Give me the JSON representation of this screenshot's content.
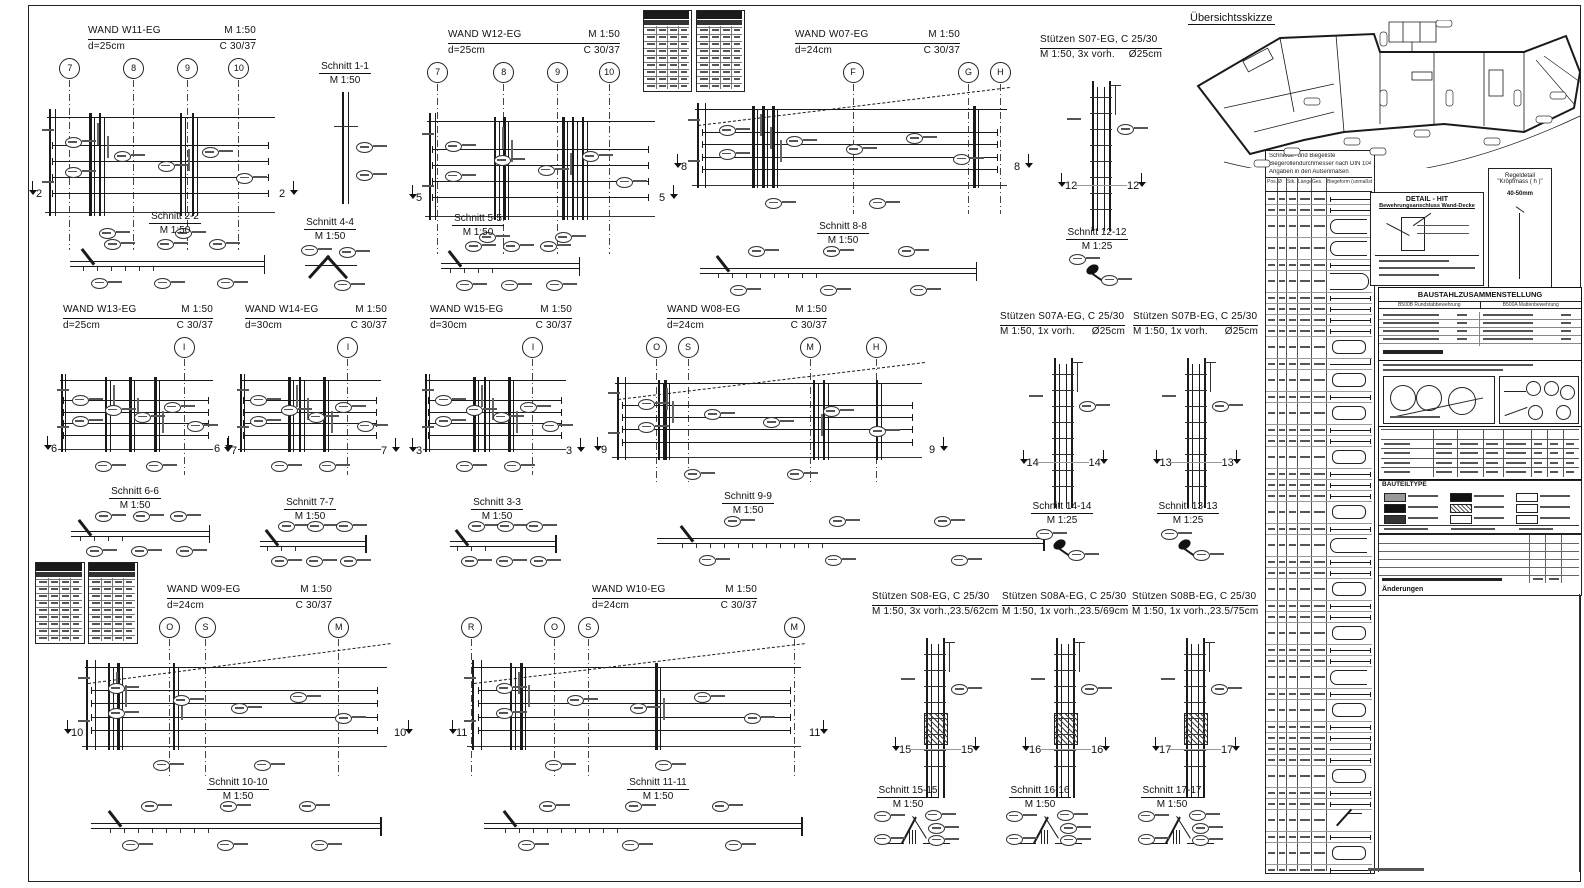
{
  "overview": {
    "title": "Übersichtsskizze"
  },
  "walls": [
    {
      "id": "w11",
      "title": "WAND W11-EG",
      "scale": "M 1:50",
      "d": "d=25cm",
      "conc": "C 30/37",
      "x": 40,
      "y": 24,
      "w": 245,
      "h": 232,
      "tl": 48,
      "tw": 168,
      "slope": false,
      "cut": "2",
      "cutfy": 0.66,
      "grids": [
        {
          "l": "7",
          "fx": 0.12
        },
        {
          "l": "8",
          "fx": 0.38
        },
        {
          "l": "9",
          "fx": 0.6
        },
        {
          "l": "10",
          "fx": 0.81
        }
      ],
      "bars": [
        0.2,
        0.24,
        0.57,
        0.62
      ]
    },
    {
      "id": "w12",
      "title": "WAND W12-EG",
      "scale": "M 1:50",
      "d": "d=25cm",
      "conc": "C 30/37",
      "x": 420,
      "y": 28,
      "w": 245,
      "h": 232,
      "tl": 28,
      "tw": 172,
      "slope": false,
      "cut": "5",
      "cutfy": 0.66,
      "grids": [
        {
          "l": "7",
          "fx": 0.07
        },
        {
          "l": "8",
          "fx": 0.34
        },
        {
          "l": "9",
          "fx": 0.56
        },
        {
          "l": "10",
          "fx": 0.77
        }
      ],
      "bars": [
        0.3,
        0.34,
        0.58,
        0.62,
        0.66
      ]
    },
    {
      "id": "w07",
      "title": "WAND W07-EG",
      "scale": "M 1:50",
      "d": "d=24cm",
      "conc": "C 30/37",
      "x": 685,
      "y": 28,
      "w": 335,
      "h": 192,
      "tl": 110,
      "tw": 165,
      "slope": true,
      "cut": "8",
      "cutfy": 0.63,
      "grids": [
        {
          "l": "F",
          "fx": 0.5
        },
        {
          "l": "G",
          "fx": 0.845
        },
        {
          "l": "H",
          "fx": 0.94
        }
      ],
      "bars": [
        0.2,
        0.23,
        0.26,
        0.86
      ]
    },
    {
      "id": "w13",
      "title": "WAND W13-EG",
      "scale": "M 1:50",
      "d": "d=25cm",
      "conc": "C 30/37",
      "x": 55,
      "y": 303,
      "w": 165,
      "h": 178,
      "tl": 8,
      "tw": 150,
      "slope": false,
      "cut": "6",
      "cutfy": 0.74,
      "grids": [
        {
          "l": "I",
          "fx": 0.78
        }
      ],
      "bars": [
        0.3,
        0.45,
        0.6
      ]
    },
    {
      "id": "w14",
      "title": "WAND W14-EG",
      "scale": "M 1:50",
      "d": "d=30cm",
      "conc": "C 30/37",
      "x": 235,
      "y": 303,
      "w": 152,
      "h": 178,
      "tl": 10,
      "tw": 142,
      "slope": false,
      "cut": "7",
      "cutfy": 0.76,
      "grids": [
        {
          "l": "I",
          "fx": 0.74
        }
      ],
      "bars": [
        0.35,
        0.42,
        0.58
      ]
    },
    {
      "id": "w15",
      "title": "WAND W15-EG",
      "scale": "M 1:50",
      "d": "d=30cm",
      "conc": "C 30/37",
      "x": 420,
      "y": 303,
      "w": 152,
      "h": 178,
      "tl": 10,
      "tw": 142,
      "slope": false,
      "cut": "3",
      "cutfy": 0.76,
      "grids": [
        {
          "l": "I",
          "fx": 0.74
        }
      ],
      "bars": [
        0.35,
        0.42,
        0.58
      ]
    },
    {
      "id": "w08",
      "title": "WAND W08-EG",
      "scale": "M 1:50",
      "d": "d=24cm",
      "conc": "C 30/37",
      "x": 605,
      "y": 303,
      "w": 330,
      "h": 188,
      "tl": 62,
      "tw": 160,
      "slope": true,
      "cut": "9",
      "cutfy": 0.7,
      "grids": [
        {
          "l": "O",
          "fx": 0.155
        },
        {
          "l": "S",
          "fx": 0.25
        },
        {
          "l": "M",
          "fx": 0.62
        },
        {
          "l": "H",
          "fx": 0.82
        }
      ],
      "bars": [
        0.16,
        0.18,
        0.63,
        0.66,
        0.82
      ]
    },
    {
      "id": "w09",
      "title": "WAND W09-EG",
      "scale": "M 1:50",
      "d": "d=24cm",
      "conc": "C 30/37",
      "x": 75,
      "y": 583,
      "w": 325,
      "h": 200,
      "tl": 92,
      "tw": 165,
      "slope": true,
      "cut": "10",
      "cutfy": 0.67,
      "grids": [
        {
          "l": "O",
          "fx": 0.29
        },
        {
          "l": "S",
          "fx": 0.4
        },
        {
          "l": "M",
          "fx": 0.81
        }
      ],
      "bars": [
        0.1,
        0.13,
        0.3
      ]
    },
    {
      "id": "w10",
      "title": "WAND W10-EG",
      "scale": "M 1:50",
      "d": "d=24cm",
      "conc": "C 30/37",
      "x": 460,
      "y": 583,
      "w": 355,
      "h": 200,
      "tl": 132,
      "tw": 165,
      "slope": true,
      "cut": "11",
      "cutfy": 0.67,
      "grids": [
        {
          "l": "R",
          "fx": 0.03
        },
        {
          "l": "O",
          "fx": 0.265
        },
        {
          "l": "S",
          "fx": 0.36
        },
        {
          "l": "M",
          "fx": 0.94
        }
      ],
      "bars": [
        0.14,
        0.17,
        0.55
      ]
    }
  ],
  "columns": [
    {
      "id": "s07",
      "title": "Stützen S07-EG, C 25/30",
      "sub": "M 1:50, 3x vorh.",
      "size": "Ø25cm",
      "x": 1040,
      "y": 33,
      "w": 122,
      "dh": 150,
      "cut": "12",
      "hatch": false
    },
    {
      "id": "s07a",
      "title": "Stützen S07A-EG, C 25/30",
      "sub": "M 1:50, 1x vorh.",
      "size": "Ø25cm",
      "x": 1000,
      "y": 310,
      "w": 125,
      "dh": 150,
      "cut": "14",
      "hatch": false
    },
    {
      "id": "s07b",
      "title": "Stützen S07B-EG, C 25/30",
      "sub": "M 1:50, 1x vorh.",
      "size": "Ø25cm",
      "x": 1133,
      "y": 310,
      "w": 125,
      "dh": 150,
      "cut": "13",
      "hatch": false
    },
    {
      "id": "s08",
      "title": "Stützen S08-EG,  C 25/30",
      "sub": "M 1:50, 3x vorh.,",
      "size": "23.5/62cm",
      "x": 872,
      "y": 590,
      "w": 126,
      "dh": 160,
      "cut": "15",
      "hatch": true
    },
    {
      "id": "s08a",
      "title": "Stützen S08A-EG, C 25/30",
      "sub": "M 1:50, 1x vorh.,",
      "size": "23.5/69cm",
      "x": 1002,
      "y": 590,
      "w": 126,
      "dh": 160,
      "cut": "16",
      "hatch": true
    },
    {
      "id": "s08b",
      "title": "Stützen S08B-EG, C 25/30",
      "sub": "M 1:50, 1x vorh.,",
      "size": "23.5/75cm",
      "x": 1132,
      "y": 590,
      "w": 126,
      "dh": 160,
      "cut": "17",
      "hatch": true
    }
  ],
  "sections": [
    {
      "label": "Schnitt 1-1",
      "scale": "M 1:50",
      "cx": 345,
      "ty": 60,
      "type": "vwall",
      "dx": 328,
      "dy": 92,
      "dw": 36,
      "dh": 112
    },
    {
      "label": "Schnitt 2-2",
      "scale": "M 1:50",
      "cx": 175,
      "ty": 210,
      "type": "slab",
      "dx": 62,
      "dy": 238,
      "dw": 210,
      "dh": 55
    },
    {
      "label": "Schnitt 4-4",
      "scale": "M 1:50",
      "cx": 330,
      "ty": 216,
      "type": "joint",
      "dx": 298,
      "dy": 242,
      "dw": 66,
      "dh": 50
    },
    {
      "label": "Schnitt 5-5",
      "scale": "M 1:50",
      "cx": 478,
      "ty": 212,
      "type": "slab",
      "dx": 435,
      "dy": 240,
      "dw": 150,
      "dh": 55
    },
    {
      "label": "Schnitt 8-8",
      "scale": "M 1:50",
      "cx": 843,
      "ty": 220,
      "type": "slab",
      "dx": 688,
      "dy": 245,
      "dw": 300,
      "dh": 55
    },
    {
      "label": "Schnitt 12-12",
      "scale": "M 1:25",
      "cx": 1097,
      "ty": 226,
      "type": "hook",
      "dx": 1068,
      "dy": 252,
      "dw": 60,
      "dh": 38
    },
    {
      "label": "Schnitt 6-6",
      "scale": "M 1:50",
      "cx": 135,
      "ty": 485,
      "type": "slab",
      "dx": 65,
      "dy": 510,
      "dw": 150,
      "dh": 50
    },
    {
      "label": "Schnitt 7-7",
      "scale": "M 1:50",
      "cx": 310,
      "ty": 496,
      "type": "slab",
      "dx": 255,
      "dy": 520,
      "dw": 115,
      "dh": 50
    },
    {
      "label": "Schnitt 3-3",
      "scale": "M 1:50",
      "cx": 497,
      "ty": 496,
      "type": "slab",
      "dx": 445,
      "dy": 520,
      "dw": 115,
      "dh": 50
    },
    {
      "label": "Schnitt 9-9",
      "scale": "M 1:50",
      "cx": 748,
      "ty": 490,
      "type": "slab",
      "dx": 640,
      "dy": 515,
      "dw": 420,
      "dh": 55
    },
    {
      "label": "Schnitt 14-14",
      "scale": "M 1:25",
      "cx": 1062,
      "ty": 500,
      "type": "hook",
      "dx": 1035,
      "dy": 527,
      "dw": 60,
      "dh": 38
    },
    {
      "label": "Schnitt 13-13",
      "scale": "M 1:25",
      "cx": 1188,
      "ty": 500,
      "type": "hook",
      "dx": 1160,
      "dy": 527,
      "dw": 60,
      "dh": 38
    },
    {
      "label": "Schnitt 10-10",
      "scale": "M 1:50",
      "cx": 238,
      "ty": 776,
      "type": "slab",
      "dx": 78,
      "dy": 800,
      "dw": 315,
      "dh": 55
    },
    {
      "label": "Schnitt 11-11",
      "scale": "M 1:50",
      "cx": 658,
      "ty": 776,
      "type": "slab",
      "dx": 470,
      "dy": 800,
      "dw": 345,
      "dh": 55
    },
    {
      "label": "Schnitt 15-15",
      "scale": "M 1:50",
      "cx": 908,
      "ty": 784,
      "type": "wedge",
      "dx": 872,
      "dy": 806,
      "dw": 85,
      "dh": 46
    },
    {
      "label": "Schnitt 16-16",
      "scale": "M 1:50",
      "cx": 1040,
      "ty": 784,
      "type": "wedge",
      "dx": 1004,
      "dy": 806,
      "dw": 85,
      "dh": 46
    },
    {
      "label": "Schnitt 17-17",
      "scale": "M 1:50",
      "cx": 1172,
      "ty": 784,
      "type": "wedge",
      "dx": 1136,
      "dy": 806,
      "dw": 85,
      "dh": 46
    }
  ],
  "miniTables": [
    {
      "x": 643,
      "y": 10,
      "w": 47,
      "h": 80
    },
    {
      "x": 696,
      "y": 10,
      "w": 47,
      "h": 80
    },
    {
      "x": 35,
      "y": 562,
      "w": 48,
      "h": 80
    },
    {
      "x": 88,
      "y": 562,
      "w": 48,
      "h": 80
    }
  ],
  "schedule": {
    "x": 1265,
    "y": 150,
    "w": 108,
    "h": 722,
    "notes": [
      "Schneide- und Biegeliste",
      "Biegerollendurchmesser nach DIN 1045",
      "Angaben in den Außenmaßen"
    ],
    "header": [
      "Pos.",
      "Ø",
      "Stk.",
      "Länge",
      "Ges.",
      "Biegeform (unmaßstäbl.)"
    ],
    "rows": [
      "l",
      "l",
      "U",
      "U",
      "l",
      "J",
      "l",
      "l",
      "l",
      "l",
      "O",
      "e",
      "O",
      "l",
      "O",
      "l",
      "l",
      "O",
      "l",
      "l",
      "l",
      "O",
      "l",
      "U",
      "l",
      "l",
      "O",
      "l",
      "l",
      "O",
      "l",
      "l",
      "U",
      "l",
      "O",
      "l",
      "l",
      "e",
      "l",
      "O",
      "l",
      "l",
      "j",
      "l",
      "O",
      "l"
    ]
  },
  "rightPanel": {
    "detail": {
      "title": "DETAIL  -  HIT",
      "subtitle": "Bewehrungsanschluss Wand-Decke"
    },
    "regel": {
      "l1": "Regeldetail",
      "l2": "\"Kröpfmass ( h )\"",
      "l3": "40-50mm"
    },
    "steel": {
      "title": "BAUSTAHLZUSAMMENSTELLUNG",
      "left": "B500B  Rundstabbewehrung",
      "right": "B500A  Mattenbewehrung"
    },
    "bauteil": {
      "title": "BAUTEILTYPE"
    },
    "revision": {
      "note": "Änderungen"
    }
  },
  "colors": {
    "ink": "#1a1a1a",
    "gray": "#555",
    "swatches": [
      "#999",
      "#111",
      "#333",
      "#111",
      "dots",
      "#fff",
      "#fff",
      "#fff",
      "#fff"
    ]
  }
}
